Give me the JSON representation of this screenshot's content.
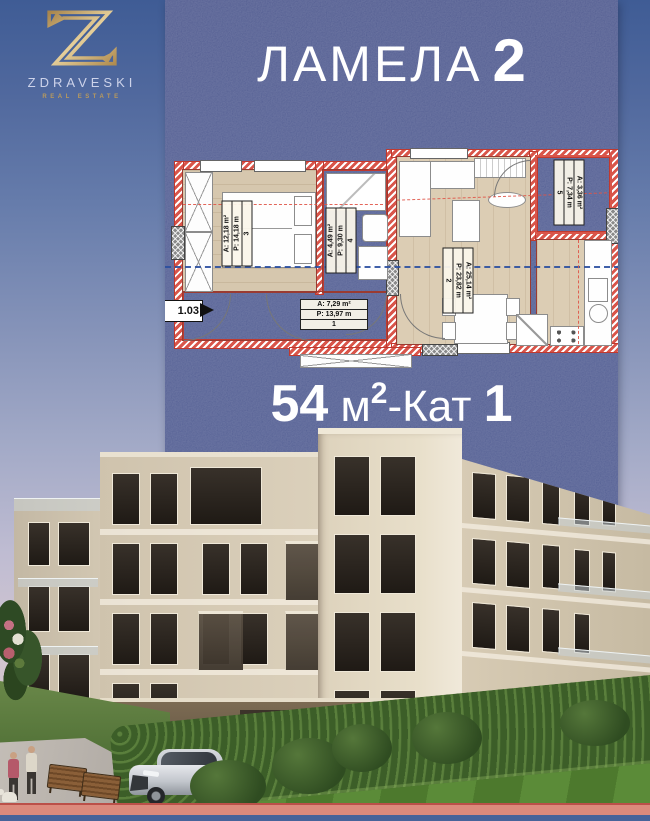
{
  "logo": {
    "brand": "ZDRAVESKI",
    "tagline": "REAL ESTATE"
  },
  "header": {
    "title": "ЛАМЕЛА",
    "title_number": "2"
  },
  "area_line": {
    "value": "54",
    "unit_base": "м",
    "unit_sup": "2",
    "separator": "-",
    "floor_label": "Кат",
    "floor_number": "1"
  },
  "floorplan": {
    "entry_label": "1.03",
    "rooms": [
      {
        "name": "hall",
        "area": "A: 7,29 m²",
        "perimeter": "P: 13,97 m",
        "number": "1"
      },
      {
        "name": "living-room",
        "area": "A: 25,14 m²",
        "perimeter": "P: 23,82 m",
        "number": "2"
      },
      {
        "name": "bedroom",
        "area": "A: 12,18 m²",
        "perimeter": "P: 14,18 m",
        "number": "3"
      },
      {
        "name": "bathroom",
        "area": "A: 4,49 m²",
        "perimeter": "P: 9,30 m",
        "number": "4"
      },
      {
        "name": "terrace",
        "area": "A: 3,36 m²",
        "perimeter": "P: 7,34 m",
        "number": "5"
      }
    ]
  },
  "colors": {
    "panel": "#4d5990",
    "accent_gold": "#c9a96a",
    "wall_red": "#d9554a",
    "bottom_bar": "#dc8a7c"
  }
}
